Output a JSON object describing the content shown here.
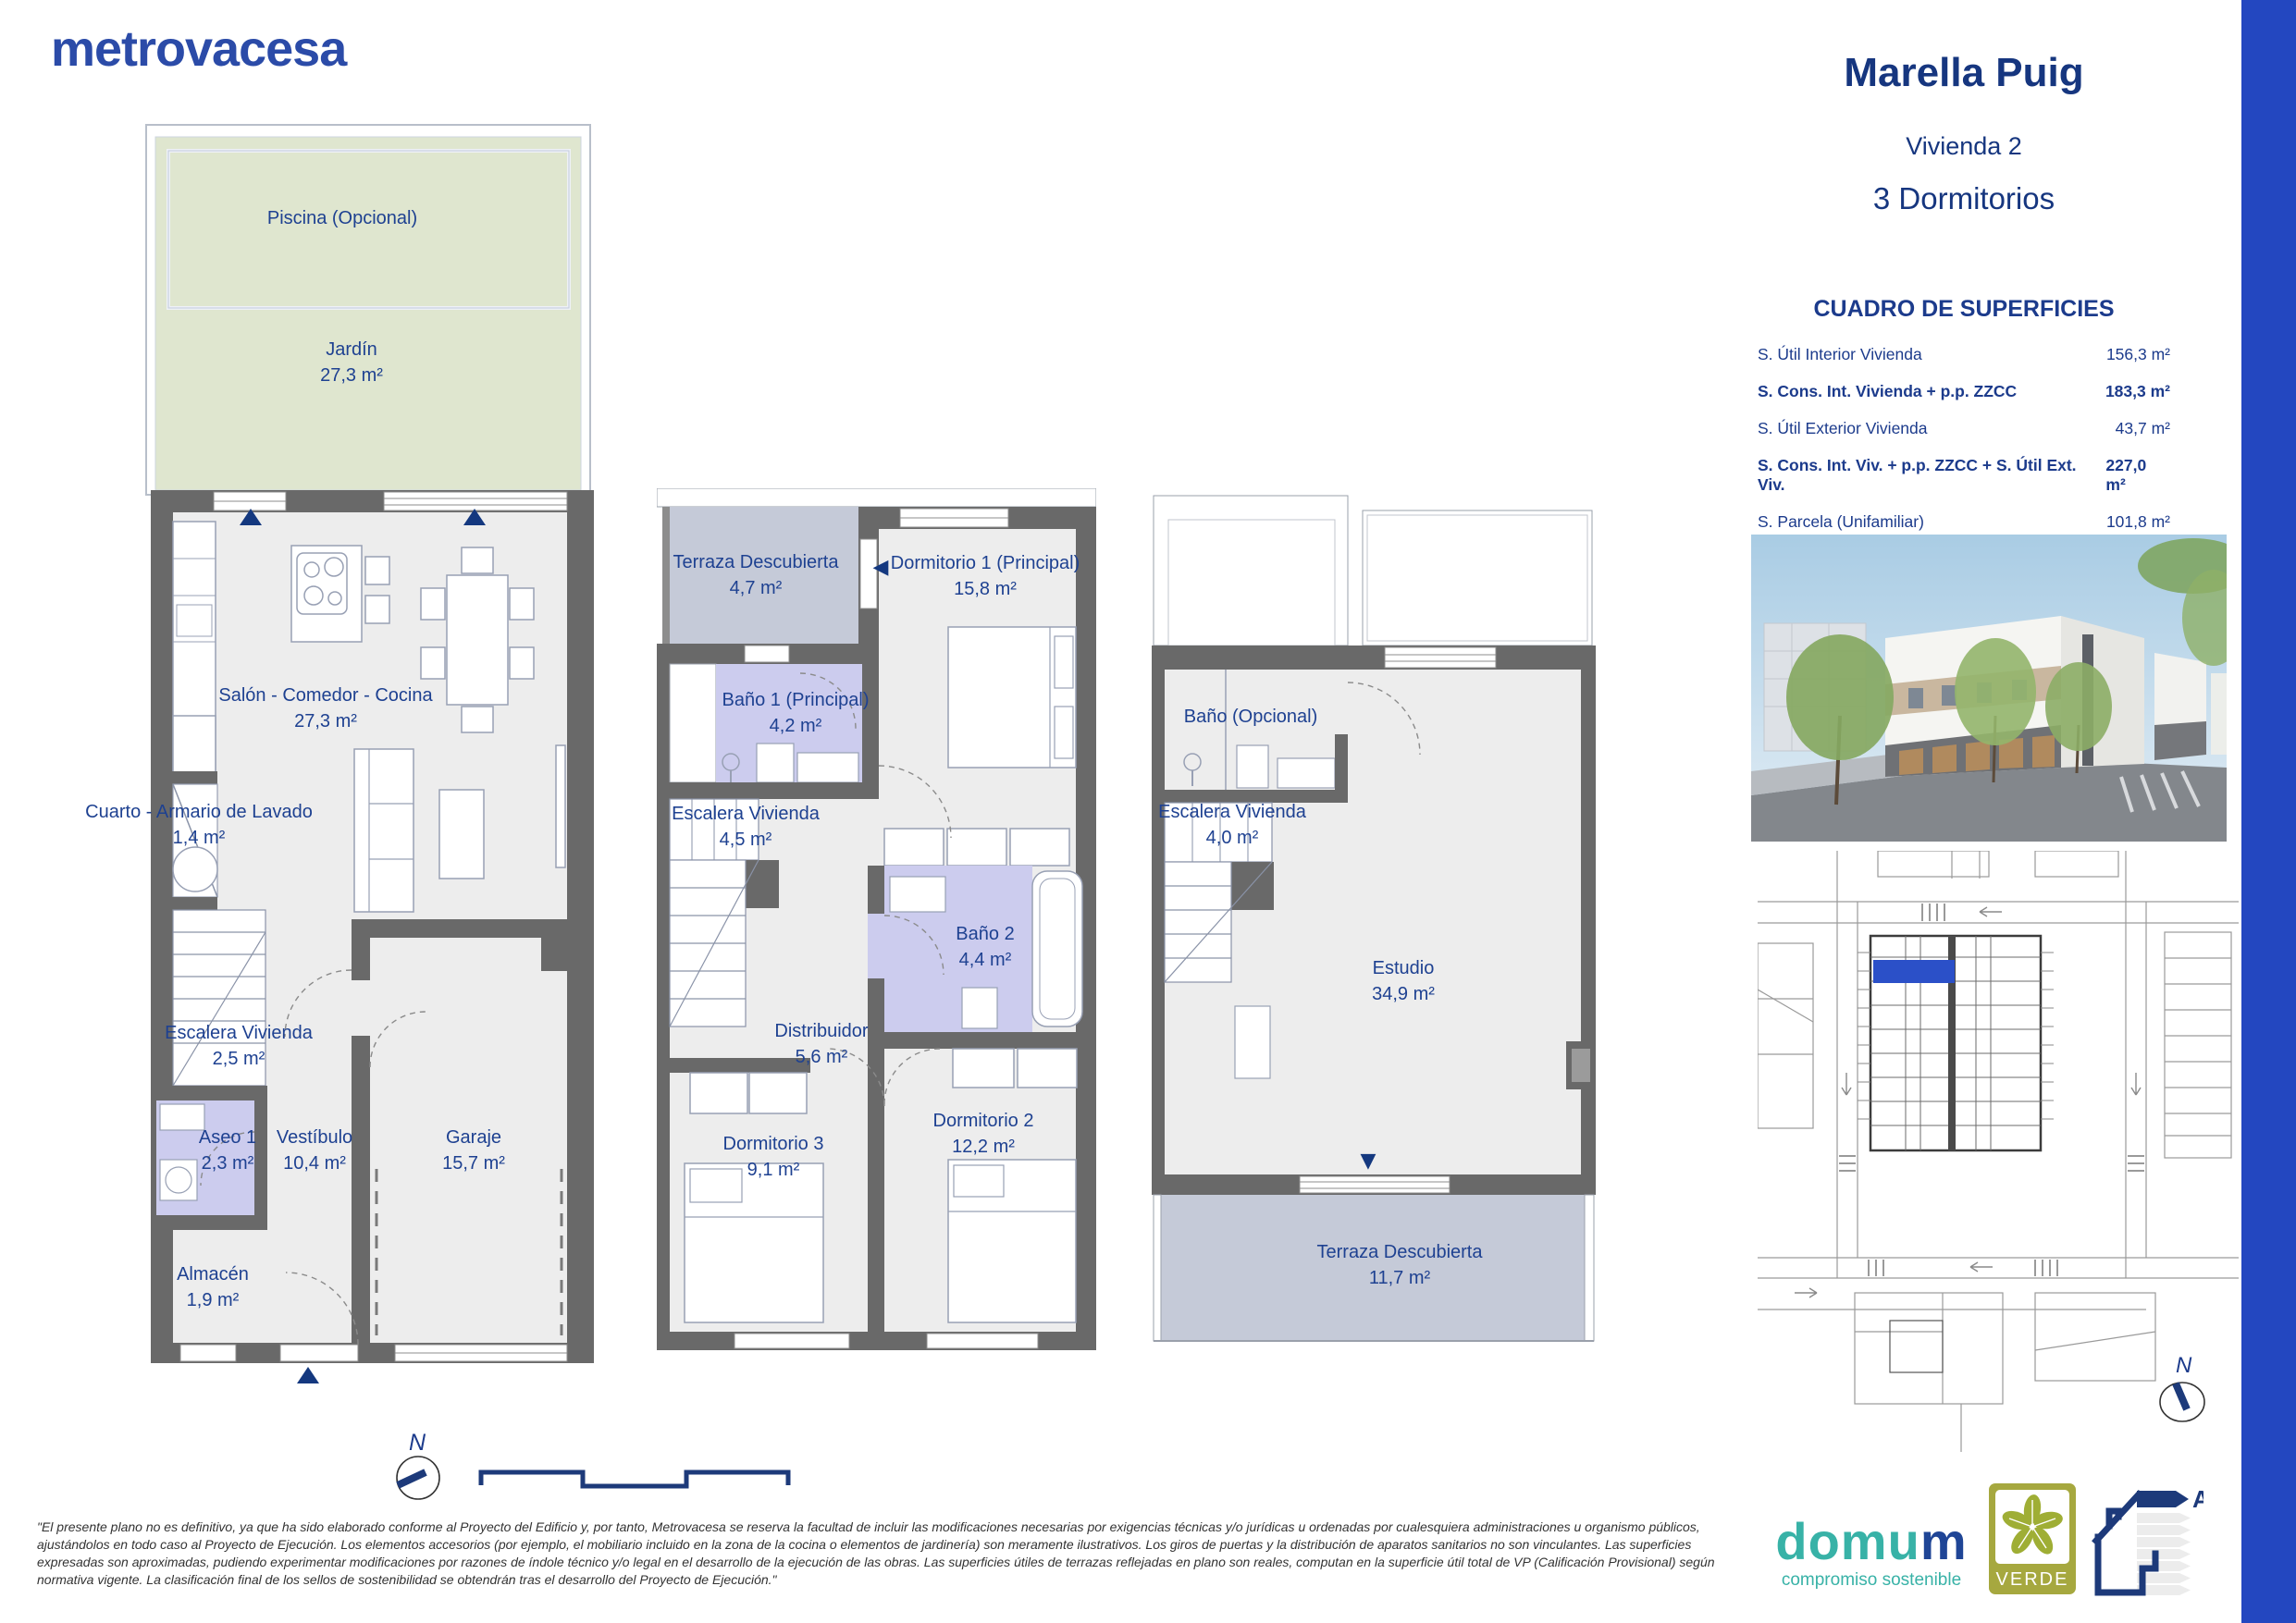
{
  "header": {
    "brand": "metrovacesa"
  },
  "project": {
    "name": "Marella Puig",
    "unit": "Vivienda 2",
    "type": "3 Dormitorios"
  },
  "surfaces": {
    "title": "CUADRO DE SUPERFICIES",
    "rows": [
      {
        "label": "S. Útil Interior Vivienda",
        "value": "156,3 m²"
      },
      {
        "label": "S. Cons. Int. Vivienda + p.p. ZZCC",
        "value": "183,3 m²"
      },
      {
        "label": "S. Útil Exterior Vivienda",
        "value": "43,7 m²"
      },
      {
        "label": "S. Cons. Int. Viv. + p.p. ZZCC + S. Útil Ext. Viv.",
        "value": "227,0 m²"
      },
      {
        "label": "S. Parcela (Unifamiliar)",
        "value": "101,8 m²"
      }
    ]
  },
  "floors": [
    {
      "rooms": [
        {
          "label": "Piscina (Opcional)",
          "area": ""
        },
        {
          "label": "Jardín",
          "area": "27,3 m²"
        },
        {
          "label": "Salón - Comedor - Cocina",
          "area": "27,3 m²"
        },
        {
          "label": "Cuarto - Armario de Lavado",
          "area": "1,4 m²"
        },
        {
          "label": "Escalera Vivienda",
          "area": "2,5 m²"
        },
        {
          "label": "Aseo 1",
          "area": "2,3 m²"
        },
        {
          "label": "Vestíbulo",
          "area": "10,4 m²"
        },
        {
          "label": "Garaje",
          "area": "15,7 m²"
        },
        {
          "label": "Almacén",
          "area": "1,9 m²"
        }
      ]
    },
    {
      "rooms": [
        {
          "label": "Terraza Descubierta",
          "area": "4,7 m²"
        },
        {
          "label": "Dormitorio 1 (Principal)",
          "area": "15,8 m²"
        },
        {
          "label": "Baño 1 (Principal)",
          "area": "4,2 m²"
        },
        {
          "label": "Escalera Vivienda",
          "area": "4,5 m²"
        },
        {
          "label": "Baño 2",
          "area": "4,4 m²"
        },
        {
          "label": "Distribuidor",
          "area": "5,6 m²"
        },
        {
          "label": "Dormitorio 3",
          "area": "9,1 m²"
        },
        {
          "label": "Dormitorio 2",
          "area": "12,2 m²"
        }
      ]
    },
    {
      "rooms": [
        {
          "label": "Baño (Opcional)",
          "area": ""
        },
        {
          "label": "Escalera Vivienda",
          "area": "4,0 m²"
        },
        {
          "label": "Estudio",
          "area": "34,9 m²"
        },
        {
          "label": "Terraza Descubierta",
          "area": "11,7 m²"
        }
      ]
    }
  ],
  "icons": {
    "entrance_arrow_up": "▲",
    "entrance_arrow_down": "▼",
    "entrance_arrow_left": "◀"
  },
  "compass": {
    "label": "N"
  },
  "site_compass": {
    "label": "N"
  },
  "energy": {
    "rating": "A"
  },
  "logos": {
    "domum": {
      "part1": "domu",
      "part2": "m",
      "tagline": "compromiso sostenible"
    },
    "verde": "VERDE"
  },
  "disclaimer": "\"El presente plano no es definitivo, ya que ha sido elaborado conforme al Proyecto del Edificio y, por tanto, Metrovacesa se reserva la facultad de incluir las modificaciones necesarias por exigencias técnicas y/o jurídicas u ordenadas por cualesquiera administraciones u organismo públicos, ajustándolos en todo caso al Proyecto de Ejecución. Los elementos accesorios (por ejemplo, el mobiliario incluido en la zona de la cocina o elementos de jardinería) son meramente ilustrativos. Los giros de puertas y la distribución de aparatos sanitarios no son vinculantes. Las superficies expresadas son aproximadas, pudiendo experimentar modificaciones por razones de índole técnico y/o legal en el desarrollo de la ejecución de las obras. Las superficies útiles de terrazas reflejadas en plano son reales, computan en la superficie útil total de VP (Calificación Provisional) según normativa vigente. La clasificación final de los sellos de sostenibilidad se obtendrán tras el desarrollo del Proyecto de Ejecución.\"",
  "colors": {
    "accent_blue": "#2347c0",
    "navy_text": "#1c3b8c",
    "wall_gray": "#696969",
    "floor_gray": "#ededed",
    "bath_lavender": "#ccccee",
    "terrace_bluegray": "#c5cad8",
    "garden_green": "#dfe6cf",
    "highlight_unit_blue": "#2b50c8",
    "domum_teal": "#38b2a7",
    "verde_olive": "#a6a83f"
  }
}
